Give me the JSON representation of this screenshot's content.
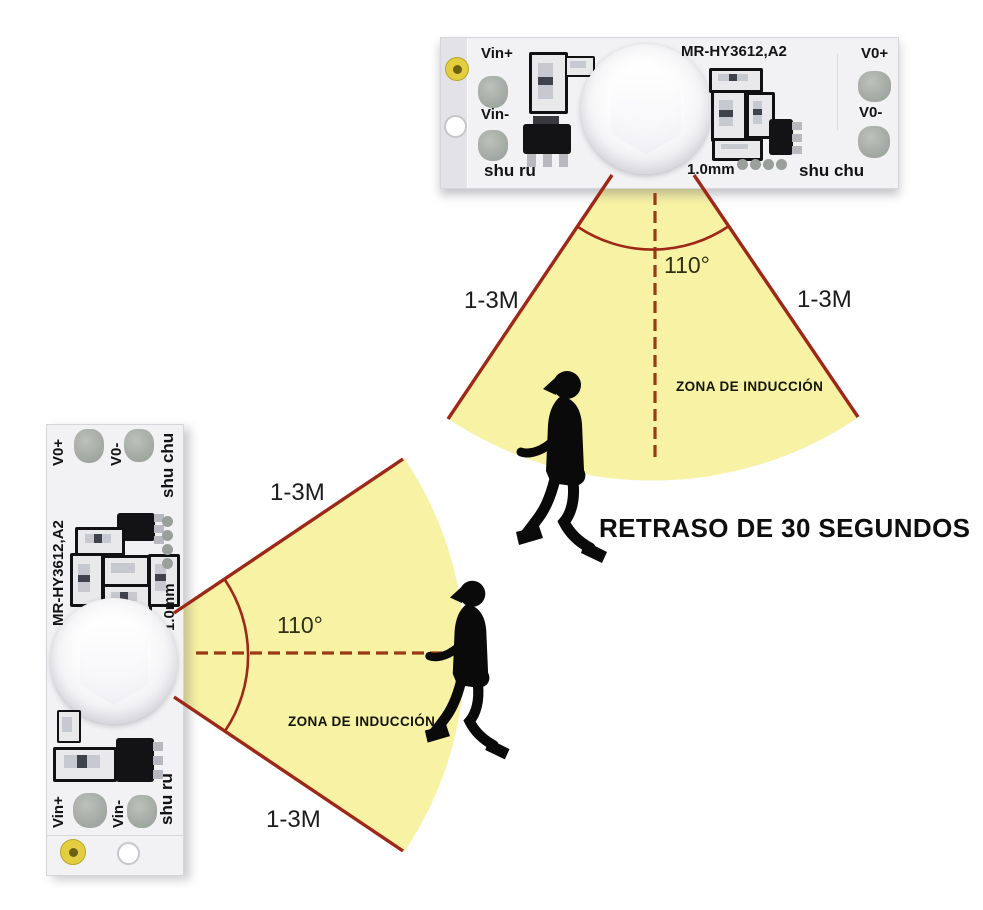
{
  "board_labels": {
    "vin_plus": "Vin+",
    "vin_minus": "Vin-",
    "vout_plus": "V0+",
    "vout_minus": "V0-",
    "input": "shu ru",
    "output": "shu chu",
    "model": "MR-HY3612,A2",
    "pitch": "1.0mm"
  },
  "top_fan": {
    "range_left": "1-3M",
    "range_right": "1-3M",
    "angle": "110°",
    "zone": "ZONA DE INDUCCIÓN"
  },
  "left_fan": {
    "range_top": "1-3M",
    "range_bottom": "1-3M",
    "angle": "110°",
    "zone": "ZONA DE INDUCCIÓN"
  },
  "caption": {
    "delay_text": "RETRASO DE 30 SEGUNDOS"
  },
  "colors": {
    "fan_fill": "#F7F2A1",
    "fan_border": "#9E2818",
    "dash_line": "#9A3A16",
    "pcb_body": "#F2F2F5",
    "solder_pad": "#A9AFA8",
    "mount_ring": "#E3CE3F",
    "silkscreen": "#111113",
    "label_text": "#131313"
  }
}
